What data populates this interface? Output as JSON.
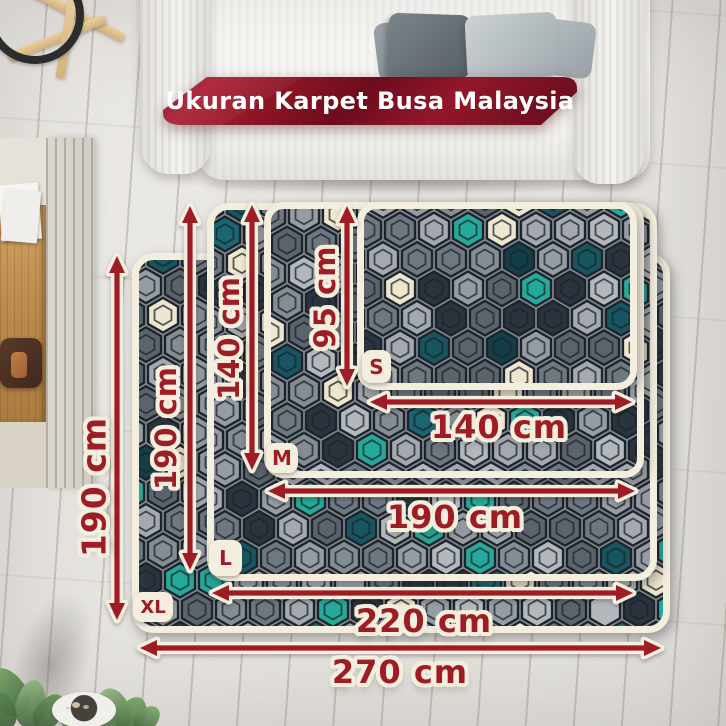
{
  "banner": {
    "title": "Ukuran Karpet Busa Malaysia",
    "text_color": "#ffffff",
    "bg_dark": "#6d0c1c",
    "bg_bright": "#ab2135"
  },
  "colors": {
    "label_red": "#9e1c24",
    "cream_outline": "#f3eedd",
    "carpet_border": "#f3eedd",
    "pattern_outline": "#1c232b",
    "pattern_base": "#7d858d",
    "teal": "#2fc0ae",
    "dark_teal": "#175660",
    "hex_cream": "#e9ddc0",
    "charcoal": "#39424c"
  },
  "carpets": [
    {
      "id": "xl",
      "size_label": "XL",
      "width_label": "270 cm",
      "height_label": "190 cm",
      "rect": {
        "x": 132,
        "y": 253,
        "w": 538,
        "h": 380,
        "r": 18
      },
      "badge": {
        "x": 133,
        "y": 592,
        "w": 40,
        "h": 30,
        "fs": 18
      },
      "phase": [
        0,
        0
      ]
    },
    {
      "id": "l",
      "size_label": "L",
      "width_label": "220 cm",
      "height_label": "190 cm",
      "rect": {
        "x": 207,
        "y": 203,
        "w": 450,
        "h": 378,
        "r": 18
      },
      "badge": {
        "x": 209,
        "y": 540,
        "w": 33,
        "h": 36,
        "fs": 20
      },
      "phase": [
        11,
        7
      ]
    },
    {
      "id": "m",
      "size_label": "M",
      "width_label": "190 cm",
      "height_label": "140 cm",
      "rect": {
        "x": 264,
        "y": 202,
        "w": 380,
        "h": 276,
        "r": 16
      },
      "badge": {
        "x": 266,
        "y": 443,
        "w": 32,
        "h": 30,
        "fs": 20
      },
      "phase": [
        5,
        17
      ]
    },
    {
      "id": "s",
      "size_label": "S",
      "width_label": "140 cm",
      "height_label": "95 cm",
      "rect": {
        "x": 357,
        "y": 202,
        "w": 280,
        "h": 188,
        "r": 16
      },
      "badge": {
        "x": 362,
        "y": 350,
        "w": 29,
        "h": 33,
        "fs": 20
      },
      "phase": [
        16,
        3
      ]
    }
  ],
  "measurements": [
    {
      "id": "xl-height",
      "label": "190 cm",
      "orient": "v",
      "x": 117,
      "y1": 256,
      "y2": 620,
      "cx": 94,
      "cy": 487,
      "fs": 33
    },
    {
      "id": "l-height",
      "label": "190 cm",
      "orient": "v",
      "x": 190,
      "y1": 206,
      "y2": 570,
      "cx": 166,
      "cy": 428,
      "fs": 29
    },
    {
      "id": "m-height",
      "label": "140 cm",
      "orient": "v",
      "x": 252,
      "y1": 205,
      "y2": 470,
      "cx": 229,
      "cy": 338,
      "fs": 29
    },
    {
      "id": "s-height",
      "label": "95 cm",
      "orient": "v",
      "x": 347,
      "y1": 206,
      "y2": 386,
      "cx": 325,
      "cy": 297,
      "fs": 29
    },
    {
      "id": "s-width",
      "label": "140 cm",
      "orient": "h",
      "y": 402,
      "x1": 370,
      "x2": 632,
      "cx": 499,
      "cy": 427,
      "fs": 32
    },
    {
      "id": "m-width",
      "label": "190 cm",
      "orient": "h",
      "y": 491,
      "x1": 268,
      "x2": 635,
      "cx": 455,
      "cy": 517,
      "fs": 32
    },
    {
      "id": "l-width",
      "label": "220 cm",
      "orient": "h",
      "y": 593,
      "x1": 212,
      "x2": 633,
      "cx": 424,
      "cy": 621,
      "fs": 32
    },
    {
      "id": "xl-width",
      "label": "270 cm",
      "orient": "h",
      "y": 648,
      "x1": 140,
      "x2": 661,
      "cx": 400,
      "cy": 672,
      "fs": 32
    }
  ]
}
